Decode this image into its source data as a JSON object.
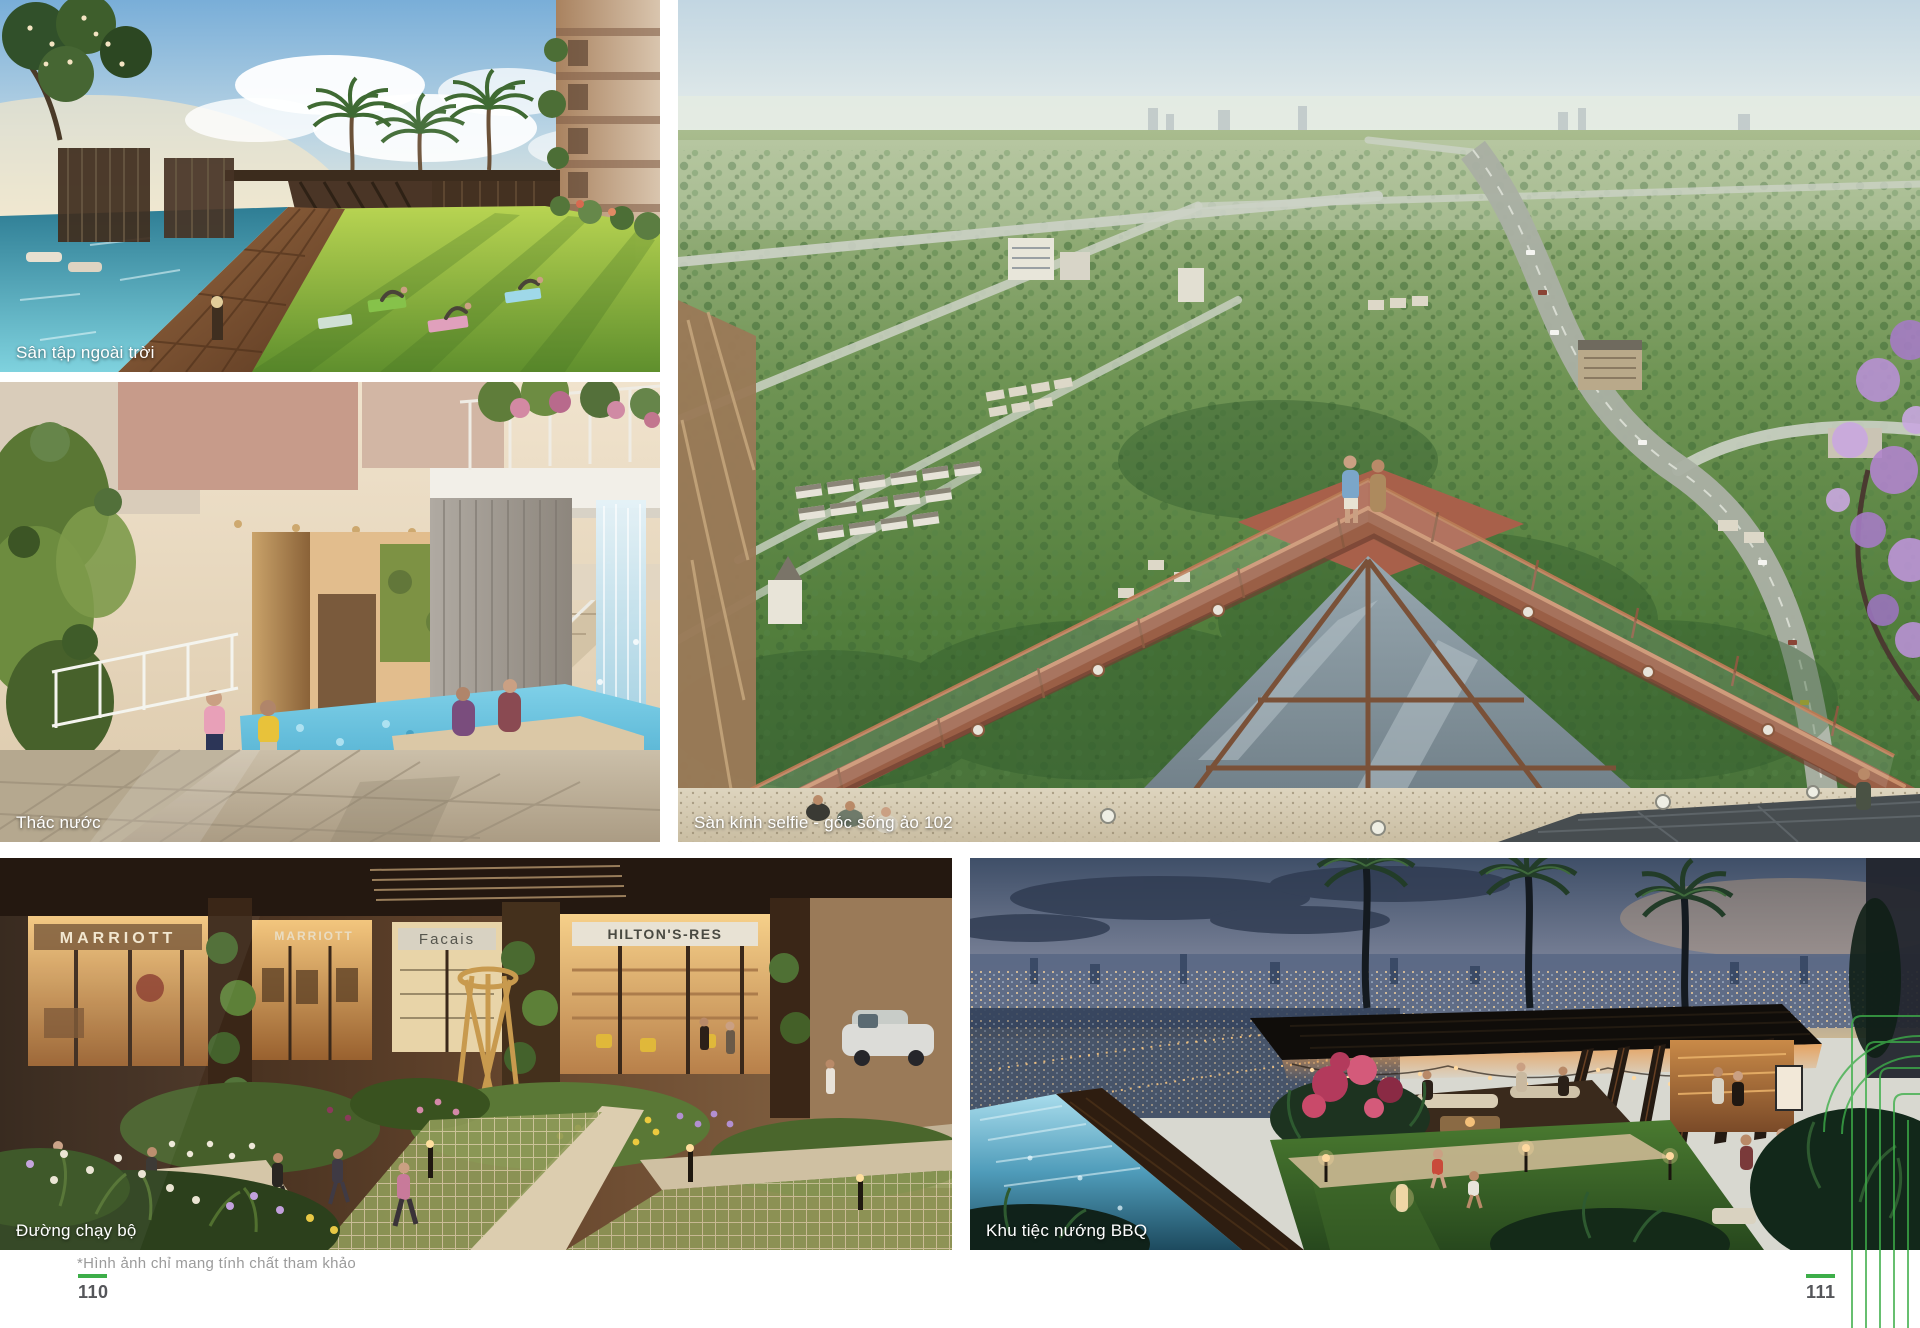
{
  "brochure": {
    "disclaimer": "*Hình ảnh chỉ mang tính chất tham khảo",
    "left_page_number": "110",
    "right_page_number": "111",
    "accent_green": "#3DAE49"
  },
  "photos": {
    "outdoor_gym": {
      "caption": "Sân tập ngoài trời"
    },
    "waterfall": {
      "caption": "Thác nước"
    },
    "jogging": {
      "caption": "Đường chạy bộ",
      "storefront_signs": [
        "MARRIOTT",
        "MARRIOTT",
        "Facais",
        "HILTON'S-RES"
      ]
    },
    "selfie_deck": {
      "caption": "Sàn kính selfie - góc sống ảo 102"
    },
    "bbq": {
      "caption": "Khu tiệc nướng BBQ"
    }
  }
}
